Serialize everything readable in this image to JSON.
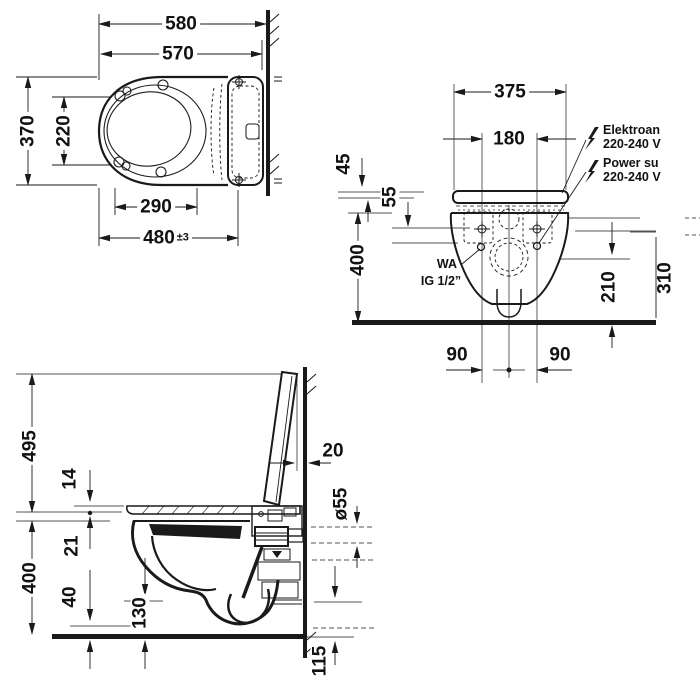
{
  "drawing": {
    "colors": {
      "ink": "#1a1a1a",
      "background": "#ffffff"
    },
    "icons": {
      "electrical": "lightning-icon",
      "power": "lightning-icon"
    },
    "top_view": {
      "overall_depth": "580",
      "ceramic_depth": "570",
      "width": "370",
      "bowl_inner_width": "220",
      "inner_depth": "290",
      "fixing_depth": "480",
      "fixing_tolerance": "±3"
    },
    "front_view": {
      "width": "375",
      "fixing_distance": "180",
      "top_offset": "45",
      "cover_height": "55",
      "rim_height": "400",
      "outlet_height": "210",
      "right_partial_dim": "310",
      "fixing_left": "90",
      "fixing_right": "90",
      "electrical_label_line1": "Elektroan",
      "electrical_label_line2": "220-240 V",
      "power_label_line1": "Power su",
      "power_label_line2": "220-240 V",
      "water_label_line1": "WA",
      "water_label_line2": "IG 1/2”"
    },
    "side_view": {
      "open_lid_height": "495",
      "seat_thickness": "14",
      "seat_to_rim": "21",
      "rim_height": "400",
      "bowl_front_height": "40",
      "bowl_bottom_height": "130",
      "lid_wall_gap": "20",
      "outlet_diameter": "ø55",
      "outlet_bottom_height": "115"
    }
  }
}
